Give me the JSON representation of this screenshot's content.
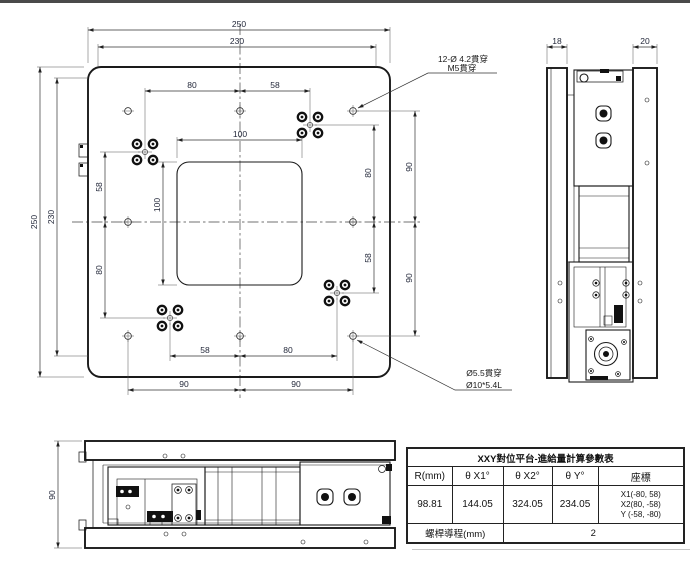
{
  "top_view": {
    "dims": {
      "overall_w": "250",
      "holes_w": "230",
      "top_80": "80",
      "top_58": "58",
      "opening_w": "100",
      "opening_h": "100",
      "overall_h": "250",
      "holes_h": "230",
      "left_58": "58",
      "left_80": "80",
      "right_80": "80",
      "right_58": "58",
      "right_90_top": "90",
      "right_90_bottom": "90",
      "bottom_58": "58",
      "bottom_80": "80",
      "bottom_90_left": "90",
      "bottom_90_right": "90"
    },
    "callout_m5": {
      "line1": "12-Ø 4.2貫穿",
      "line2": "M5貫穿"
    },
    "callout_cbore": {
      "line1": "Ø5.5貫穿",
      "line2": "Ø10*5.4L"
    }
  },
  "side_view": {
    "dims": {
      "left_plate": "18",
      "right_plate": "20"
    }
  },
  "front_view": {
    "dims": {
      "height": "90"
    }
  },
  "table": {
    "title": "XXY對位平台-進給量計算參數表",
    "headers": [
      "R(mm)",
      "θ X1°",
      "θ X2°",
      "θ Y°",
      "座標"
    ],
    "values": [
      "98.81",
      "144.05",
      "324.05",
      "234.05"
    ],
    "coords": [
      "X1(-80, 58)",
      "X2(80, -58)",
      "Y (-58, -80)"
    ],
    "lead_label": "螺桿導程(mm)",
    "lead_value": "2"
  }
}
